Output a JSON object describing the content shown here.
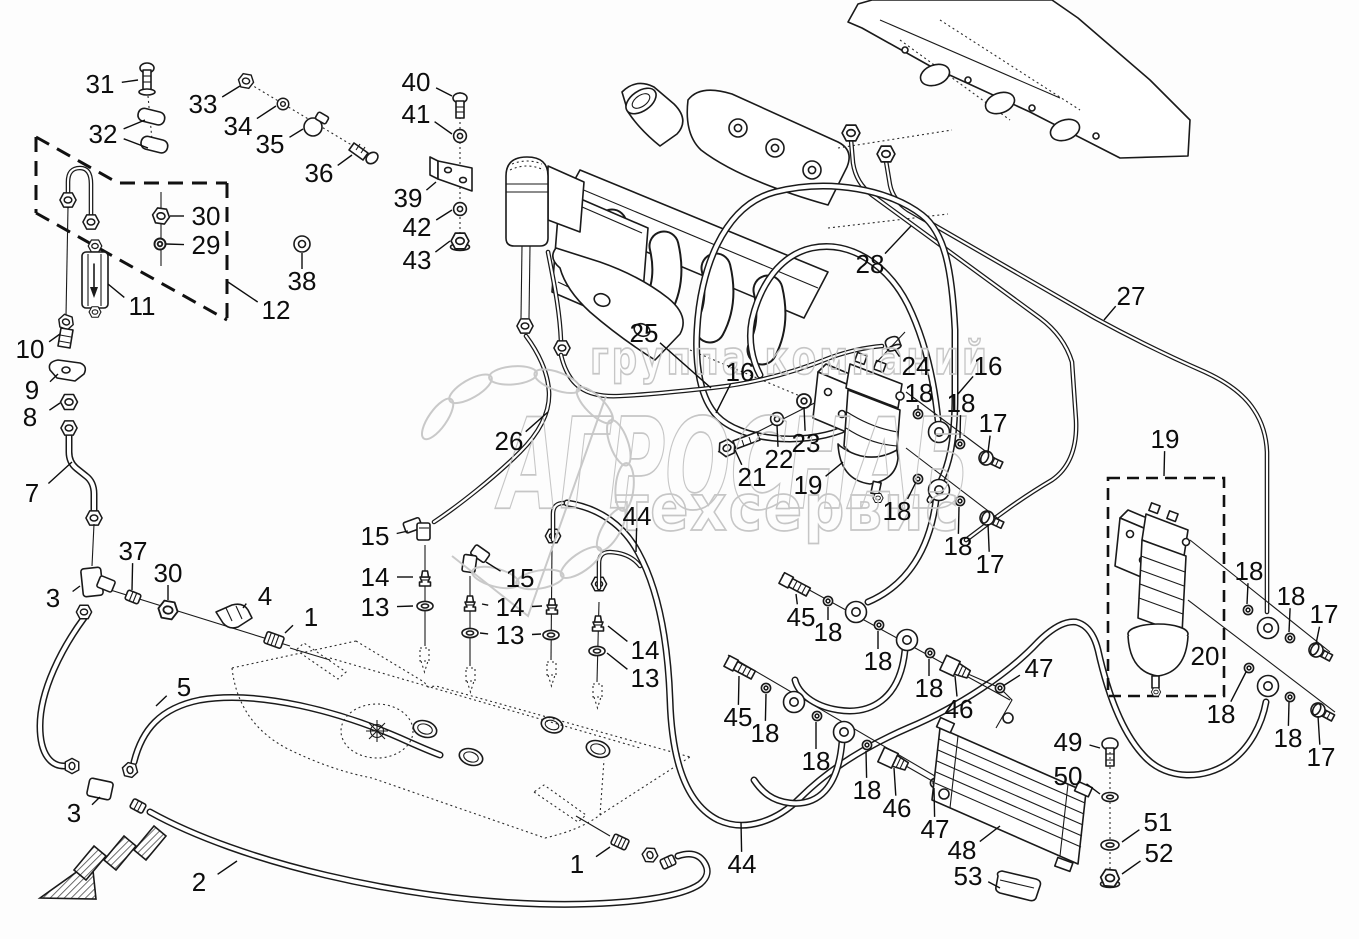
{
  "doc": {
    "kind": "exploded-parts-diagram",
    "subject": "fuel-lines-and-filters",
    "background_color": "#fdfdfd",
    "line_color": "#1a1a1a"
  },
  "watermark": {
    "line1": "группа компаний",
    "line2": "АГРОСНАБ",
    "line3": "техсервис",
    "color": "#c4c4c4",
    "logo": "laurel-wreath"
  },
  "callouts": [
    {
      "n": "31",
      "x": 100,
      "y": 84,
      "lx": 138,
      "ly": 80
    },
    {
      "n": "32",
      "x": 103,
      "y": 134,
      "lx": 145,
      "ly": 120,
      "lx2": 148,
      "ly2": 148
    },
    {
      "n": "33",
      "x": 203,
      "y": 104,
      "lx": 240,
      "ly": 86
    },
    {
      "n": "34",
      "x": 238,
      "y": 126,
      "lx": 276,
      "ly": 106
    },
    {
      "n": "35",
      "x": 270,
      "y": 144,
      "lx": 303,
      "ly": 129
    },
    {
      "n": "36",
      "x": 319,
      "y": 173,
      "lx": 352,
      "ly": 155
    },
    {
      "n": "30",
      "x": 206,
      "y": 216,
      "lx": 170,
      "ly": 216
    },
    {
      "n": "29",
      "x": 206,
      "y": 245,
      "lx": 166,
      "ly": 244
    },
    {
      "n": "38",
      "x": 302,
      "y": 281,
      "lx": 302,
      "ly": 253
    },
    {
      "n": "12",
      "x": 276,
      "y": 310,
      "lx": 228,
      "ly": 282
    },
    {
      "n": "11",
      "x": 142,
      "y": 306,
      "lx": 108,
      "ly": 284
    },
    {
      "n": "10",
      "x": 30,
      "y": 349,
      "lx": 60,
      "ly": 334
    },
    {
      "n": "9",
      "x": 32,
      "y": 390,
      "lx": 58,
      "ly": 374
    },
    {
      "n": "8",
      "x": 30,
      "y": 417,
      "lx": 60,
      "ly": 403
    },
    {
      "n": "7",
      "x": 32,
      "y": 493,
      "lx": 72,
      "ly": 462
    },
    {
      "n": "3",
      "x": 53,
      "y": 598,
      "lx": 80,
      "ly": 586
    },
    {
      "n": "37",
      "x": 133,
      "y": 551,
      "lx": 132,
      "ly": 590
    },
    {
      "n": "30",
      "x": 168,
      "y": 573,
      "lx": 168,
      "ly": 600
    },
    {
      "n": "4",
      "x": 265,
      "y": 596,
      "lx": 243,
      "ly": 608
    },
    {
      "n": "1",
      "x": 311,
      "y": 617,
      "lx": 285,
      "ly": 633
    },
    {
      "n": "5",
      "x": 184,
      "y": 687,
      "lx": 156,
      "ly": 706
    },
    {
      "n": "3",
      "x": 74,
      "y": 813,
      "lx": 100,
      "ly": 797
    },
    {
      "n": "2",
      "x": 199,
      "y": 882,
      "lx": 237,
      "ly": 861
    },
    {
      "n": "40",
      "x": 416,
      "y": 82,
      "lx": 452,
      "ly": 96
    },
    {
      "n": "41",
      "x": 416,
      "y": 114,
      "lx": 452,
      "ly": 134
    },
    {
      "n": "39",
      "x": 408,
      "y": 198,
      "lx": 436,
      "ly": 182
    },
    {
      "n": "42",
      "x": 417,
      "y": 227,
      "lx": 452,
      "ly": 210
    },
    {
      "n": "43",
      "x": 417,
      "y": 260,
      "lx": 450,
      "ly": 241
    },
    {
      "n": "25",
      "x": 644,
      "y": 333,
      "lx": 711,
      "ly": 388
    },
    {
      "n": "26",
      "x": 509,
      "y": 441,
      "lx": 548,
      "ly": 412
    },
    {
      "n": "16",
      "x": 740,
      "y": 372,
      "lx": 716,
      "ly": 413
    },
    {
      "n": "24",
      "x": 916,
      "y": 366,
      "lx": 895,
      "ly": 350
    },
    {
      "n": "16",
      "x": 988,
      "y": 366,
      "lx": 958,
      "ly": 394
    },
    {
      "n": "18",
      "x": 919,
      "y": 393,
      "lx": 918,
      "ly": 409
    },
    {
      "n": "18",
      "x": 961,
      "y": 403,
      "lx": 960,
      "ly": 438
    },
    {
      "n": "17",
      "x": 993,
      "y": 423,
      "lx": 988,
      "ly": 452
    },
    {
      "n": "23",
      "x": 806,
      "y": 443,
      "lx": 804,
      "ly": 407
    },
    {
      "n": "22",
      "x": 779,
      "y": 459,
      "lx": 777,
      "ly": 425
    },
    {
      "n": "21",
      "x": 752,
      "y": 477,
      "lx": 735,
      "ly": 450
    },
    {
      "n": "19",
      "x": 808,
      "y": 485,
      "lx": 843,
      "ly": 462
    },
    {
      "n": "18",
      "x": 897,
      "y": 511,
      "lx": 916,
      "ly": 482
    },
    {
      "n": "18",
      "x": 958,
      "y": 546,
      "lx": 959,
      "ly": 507
    },
    {
      "n": "17",
      "x": 990,
      "y": 564,
      "lx": 988,
      "ly": 524
    },
    {
      "n": "28",
      "x": 870,
      "y": 264,
      "lx": 911,
      "ly": 226
    },
    {
      "n": "27",
      "x": 1131,
      "y": 296,
      "lx": 1104,
      "ly": 320
    },
    {
      "n": "19",
      "x": 1165,
      "y": 439,
      "lx": 1164,
      "ly": 476
    },
    {
      "n": "18",
      "x": 1249,
      "y": 571,
      "lx": 1247,
      "ly": 604
    },
    {
      "n": "18",
      "x": 1291,
      "y": 596,
      "lx": 1289,
      "ly": 632
    },
    {
      "n": "17",
      "x": 1324,
      "y": 614,
      "lx": 1316,
      "ly": 644
    },
    {
      "n": "20",
      "x": 1205,
      "y": 656,
      "lx": 1184,
      "ly": 657
    },
    {
      "n": "18",
      "x": 1221,
      "y": 714,
      "lx": 1246,
      "ly": 672
    },
    {
      "n": "18",
      "x": 1288,
      "y": 738,
      "lx": 1289,
      "ly": 702
    },
    {
      "n": "17",
      "x": 1321,
      "y": 757,
      "lx": 1318,
      "ly": 716
    },
    {
      "n": "15",
      "x": 375,
      "y": 536,
      "lx": 408,
      "ly": 531
    },
    {
      "n": "14",
      "x": 375,
      "y": 577,
      "lx": 413,
      "ly": 577
    },
    {
      "n": "13",
      "x": 375,
      "y": 607,
      "lx": 413,
      "ly": 606
    },
    {
      "n": "15",
      "x": 520,
      "y": 578,
      "lx": 486,
      "ly": 562
    },
    {
      "n": "14",
      "x": 510,
      "y": 607,
      "lx": 482,
      "ly": 604,
      "lx2": 542,
      "ly2": 606
    },
    {
      "n": "13",
      "x": 510,
      "y": 635,
      "lx": 480,
      "ly": 633,
      "lx2": 541,
      "ly2": 634
    },
    {
      "n": "14",
      "x": 645,
      "y": 650,
      "lx": 608,
      "ly": 626
    },
    {
      "n": "13",
      "x": 645,
      "y": 678,
      "lx": 607,
      "ly": 653
    },
    {
      "n": "44",
      "x": 637,
      "y": 516,
      "lx": 636,
      "ly": 552
    },
    {
      "n": "44",
      "x": 742,
      "y": 864,
      "lx": 741,
      "ly": 822
    },
    {
      "n": "1",
      "x": 577,
      "y": 864,
      "lx": 610,
      "ly": 847
    },
    {
      "n": "45",
      "x": 801,
      "y": 617,
      "lx": 796,
      "ly": 594
    },
    {
      "n": "18",
      "x": 828,
      "y": 632,
      "lx": 828,
      "ly": 607
    },
    {
      "n": "18",
      "x": 878,
      "y": 661,
      "lx": 878,
      "ly": 631
    },
    {
      "n": "18",
      "x": 929,
      "y": 688,
      "lx": 929,
      "ly": 659
    },
    {
      "n": "46",
      "x": 959,
      "y": 709,
      "lx": 955,
      "ly": 676
    },
    {
      "n": "45",
      "x": 738,
      "y": 717,
      "lx": 739,
      "ly": 676
    },
    {
      "n": "18",
      "x": 765,
      "y": 733,
      "lx": 766,
      "ly": 694
    },
    {
      "n": "18",
      "x": 816,
      "y": 761,
      "lx": 816,
      "ly": 722
    },
    {
      "n": "18",
      "x": 867,
      "y": 790,
      "lx": 866,
      "ly": 751
    },
    {
      "n": "46",
      "x": 897,
      "y": 808,
      "lx": 894,
      "ly": 768
    },
    {
      "n": "47",
      "x": 935,
      "y": 829,
      "lx": 934,
      "ly": 788
    },
    {
      "n": "47",
      "x": 1039,
      "y": 668,
      "lx": 1003,
      "ly": 686
    },
    {
      "n": "49",
      "x": 1068,
      "y": 742,
      "lx": 1100,
      "ly": 748
    },
    {
      "n": "50",
      "x": 1068,
      "y": 776,
      "lx": 1100,
      "ly": 794
    },
    {
      "n": "51",
      "x": 1158,
      "y": 822,
      "lx": 1122,
      "ly": 842
    },
    {
      "n": "52",
      "x": 1159,
      "y": 853,
      "lx": 1122,
      "ly": 874
    },
    {
      "n": "48",
      "x": 962,
      "y": 850,
      "lx": 1000,
      "ly": 826
    },
    {
      "n": "53",
      "x": 968,
      "y": 876,
      "lx": 1000,
      "ly": 888
    }
  ]
}
